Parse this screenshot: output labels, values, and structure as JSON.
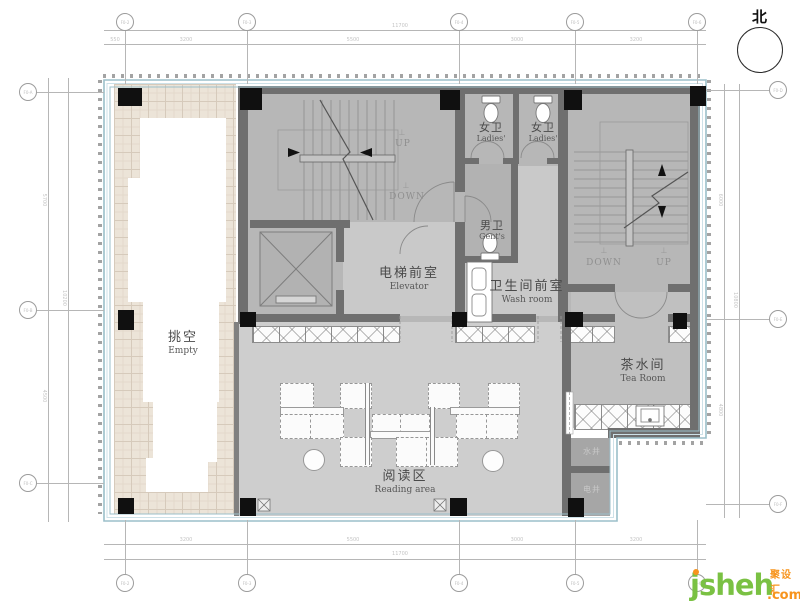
{
  "north": {
    "label": "北"
  },
  "rooms": {
    "empty": {
      "zh": "挑空",
      "en": "Empty"
    },
    "elevator_lobby": {
      "zh": "电梯前室",
      "en": "Elevator"
    },
    "ladies_1": {
      "zh": "女卫",
      "en": "Ladies'"
    },
    "ladies_2": {
      "zh": "女卫",
      "en": "Ladies'"
    },
    "gents": {
      "zh": "男卫",
      "en": "Gent's"
    },
    "washroom": {
      "zh": "卫生间前室",
      "en": "Wash room"
    },
    "tea_room": {
      "zh": "茶水间",
      "en": "Tea Room"
    },
    "reading_area": {
      "zh": "阅读区",
      "en": "Reading area"
    },
    "water_shaft": {
      "zh": "水井"
    },
    "electric_shaft": {
      "zh": "电井"
    }
  },
  "stairs": {
    "left": {
      "up_mark": "⊥",
      "up": "UP",
      "down_mark": "⊥",
      "down": "DOWN"
    },
    "right": {
      "down_mark": "⊥",
      "down": "DOWN",
      "up_mark": "⊥",
      "up": "UP"
    }
  },
  "grid_bubbles": {
    "top": [
      "F0-2",
      "F0-3",
      "F0-4",
      "F0-5",
      "F0-6"
    ],
    "bottom": [
      "F0-2",
      "F0-3",
      "F0-4",
      "F0-5",
      "F0-6"
    ],
    "left": [
      "F0-A",
      "F0-B",
      "F0-C"
    ],
    "right": [
      "F0-D",
      "F0-E",
      "F0-F"
    ]
  },
  "dimensions": {
    "top_overall": "11700",
    "top_segments": [
      "550",
      "3200",
      "5500",
      "3000",
      "3200"
    ],
    "bottom_segments": [
      "3200",
      "5500",
      "3000",
      "3200"
    ],
    "bottom_overall": "11700",
    "left_segments": [
      "5700",
      "4500"
    ],
    "left_overall": "10200",
    "right_segments": [
      "6000",
      "4800"
    ],
    "right_overall": "10800"
  },
  "logo": {
    "name": "jsheh",
    "tld": ".com",
    "cn": "聚设汇"
  },
  "colors": {
    "wall": "#6f6f6f",
    "column": "#101010",
    "room_dark": "#b7b7b7",
    "room_light": "#c9c9c9",
    "reading": "#cecece",
    "tile": "#ece4d8",
    "border_blue": "#9bbfca",
    "accent_green": "#7ac143",
    "accent_orange": "#f7941d"
  }
}
